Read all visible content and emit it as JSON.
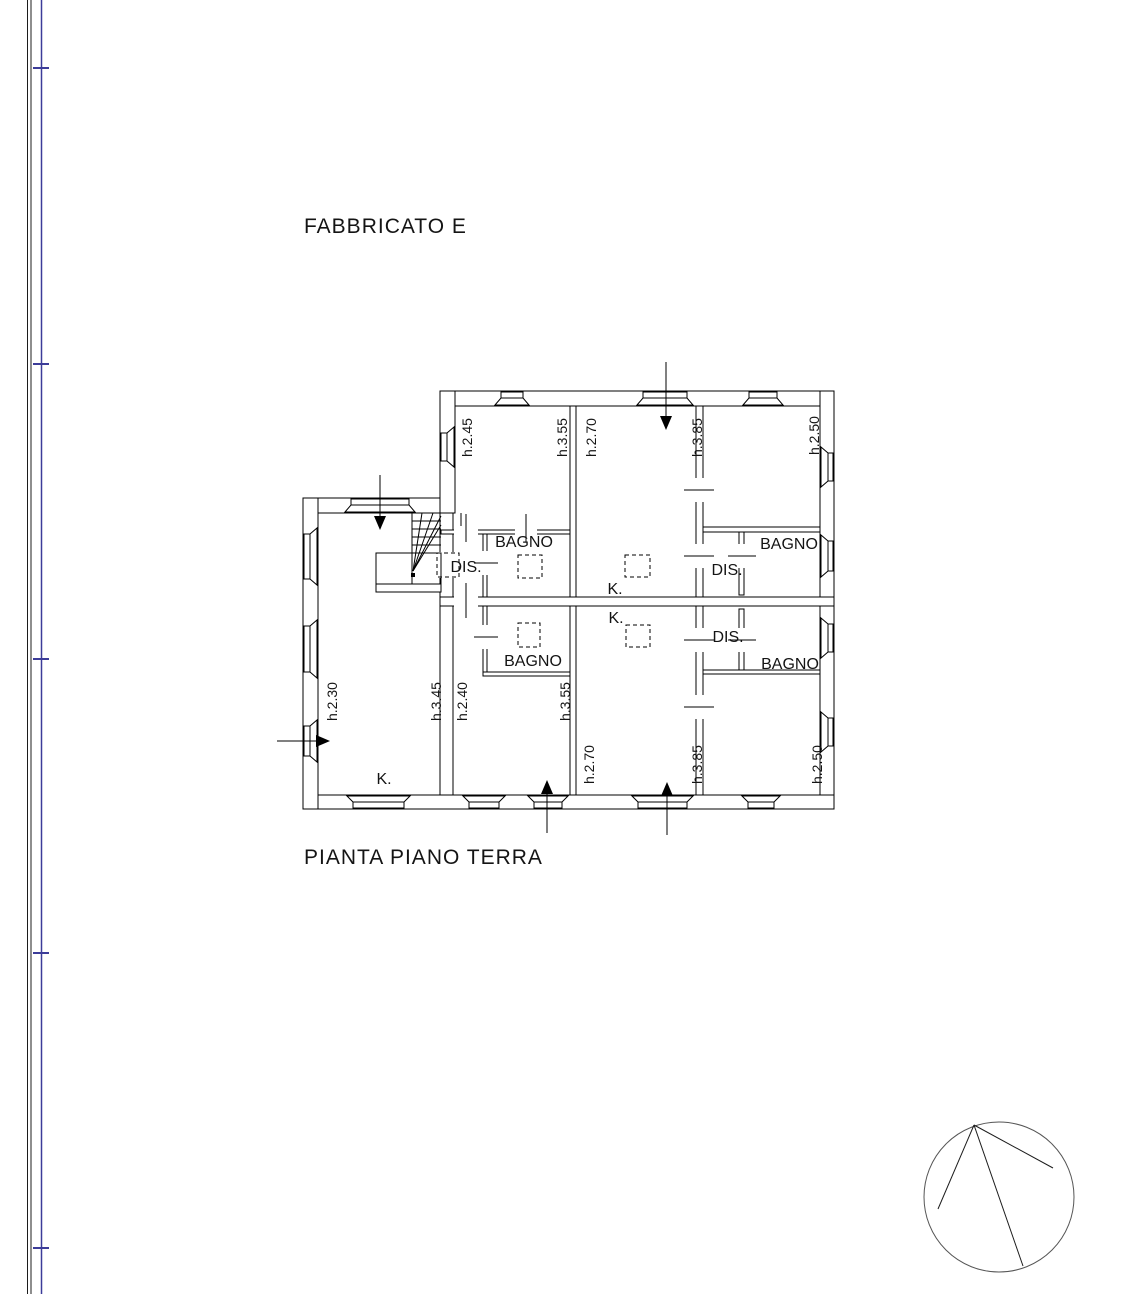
{
  "page": {
    "building_title": "FABBRICATO E",
    "plan_caption": "PIANTA PIANO TERRA"
  },
  "plan": {
    "room_labels": {
      "bagno_nw": "BAGNO",
      "dis_w": "DIS.",
      "bagno_w": "BAGNO",
      "k_north": "K.",
      "k_south": "K.",
      "k_wing": "K.",
      "dis_ne": "DIS.",
      "bagno_ne": "BAGNO",
      "dis_e": "DIS.",
      "bagno_se": "BAGNO"
    },
    "height_labels": {
      "nw_room_left": "h.2.45",
      "nw_room_right": "h.3.55",
      "n_room_left": "h.2.70",
      "n_room_right": "h.3.85",
      "ne_room": "h.2.50",
      "wing_room_left": "h.2.30",
      "wing_room_right": "h.3.45",
      "sw_room_left": "h.2.40",
      "sw_room_right": "h.3.55",
      "s_room_left": "h.2.70",
      "s_room_right": "h.3.85",
      "se_room": "h.2.50"
    }
  },
  "colors": {
    "frame_blue": "#3c3c99",
    "drawing_line": "#000000"
  }
}
